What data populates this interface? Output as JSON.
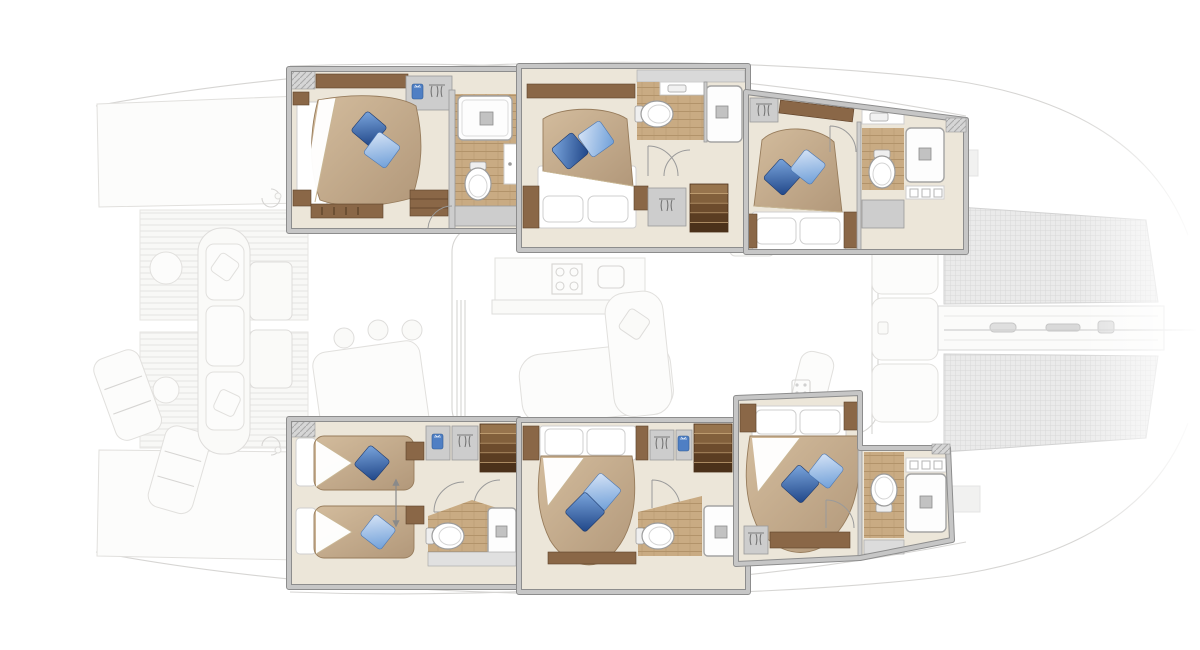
{
  "title": "Catamaran deck plan — six guest cabins highlighted",
  "orientation": {
    "bow": "right",
    "stern": "left",
    "port_hull": "top",
    "starboard_hull": "bottom"
  },
  "palette": {
    "floor": "#ece6d9",
    "wall": "#c6c6c6",
    "wallline": "#8d8d8d",
    "wood": "#8a6747",
    "woodline": "#5e4129",
    "wood-floor": "#c9ab83",
    "plank-line": "#b2936a",
    "duvet-hi": "#d3bc9d",
    "duvet-lo": "#b2987a",
    "pillow-dark-hi": "#7ba6dd",
    "pillow-dark-lo": "#1f4587",
    "pillow-light-hi": "#d5e3f6",
    "pillow-light-lo": "#6f9fd8",
    "linen": "#ffffff",
    "mesh": "#e9e9e9",
    "mesh-line": "#d6d6d6",
    "garment-blue": "#4f7fc4"
  },
  "cabins": [
    {
      "id": "cabin-port-aft",
      "hull": "port (top)",
      "bed": "double",
      "pillows": [
        "dark-blue",
        "light-blue"
      ],
      "bathroom": [
        "shower",
        "toilet",
        "vanity"
      ],
      "storage": [
        "wardrobe",
        "drawers"
      ],
      "dimmed": false
    },
    {
      "id": "cabin-port-mid",
      "hull": "port (top)",
      "bed": "double",
      "pillows": [
        "dark-blue",
        "light-blue"
      ],
      "bathroom": [
        "shower",
        "toilet",
        "vanity"
      ],
      "storage": [
        "wardrobe"
      ],
      "access": "companionway-stairs",
      "dimmed": false
    },
    {
      "id": "cabin-port-fwd",
      "hull": "port (top)",
      "bed": "double",
      "pillows": [
        "dark-blue",
        "light-blue"
      ],
      "bathroom": [
        "shower",
        "toilet",
        "vanity"
      ],
      "storage": [
        "wardrobe"
      ],
      "dimmed": false
    },
    {
      "id": "cabin-stbd-aft",
      "hull": "starboard (bottom)",
      "bed": "twin-convertible",
      "pillows": [
        "dark-blue",
        "light-blue"
      ],
      "bathroom": [
        "shower",
        "toilet",
        "vanity"
      ],
      "storage": [
        "wardrobe",
        "wardrobe"
      ],
      "access": "companionway-stairs",
      "dimmed": false
    },
    {
      "id": "cabin-stbd-mid",
      "hull": "starboard (bottom)",
      "bed": "double",
      "pillows": [
        "dark-blue",
        "light-blue"
      ],
      "bathroom": [
        "shower",
        "toilet",
        "vanity"
      ],
      "storage": [
        "wardrobe"
      ],
      "access": "companionway-stairs",
      "dimmed": false
    },
    {
      "id": "cabin-stbd-fwd",
      "hull": "starboard (bottom)",
      "bed": "double",
      "pillows": [
        "dark-blue",
        "light-blue"
      ],
      "bathroom": [
        "shower",
        "toilet",
        "vanity"
      ],
      "storage": [
        "hanging-locker"
      ],
      "dimmed": false
    }
  ],
  "shared_areas": [
    {
      "id": "stern-platforms",
      "dimmed": true,
      "items": [
        "port-platform",
        "starboard-platform"
      ]
    },
    {
      "id": "aft-deck",
      "dimmed": true,
      "items": [
        "deck-grating",
        "lounge-chairs",
        "helm-seat",
        "winches"
      ]
    },
    {
      "id": "cockpit",
      "dimmed": true,
      "items": [
        "bench-seat",
        "coffee-tables",
        "dining-table",
        "chairs"
      ]
    },
    {
      "id": "salon-galley",
      "dimmed": true,
      "items": [
        "galley-counter",
        "stove",
        "sink",
        "sofa",
        "nav-seat",
        "sliding-door"
      ]
    },
    {
      "id": "foredeck",
      "dimmed": true,
      "items": [
        "deck-lockers",
        "deck-hatches",
        "trampoline-port",
        "trampoline-starboard",
        "anchor-walkway",
        "bowsprit"
      ]
    }
  ]
}
